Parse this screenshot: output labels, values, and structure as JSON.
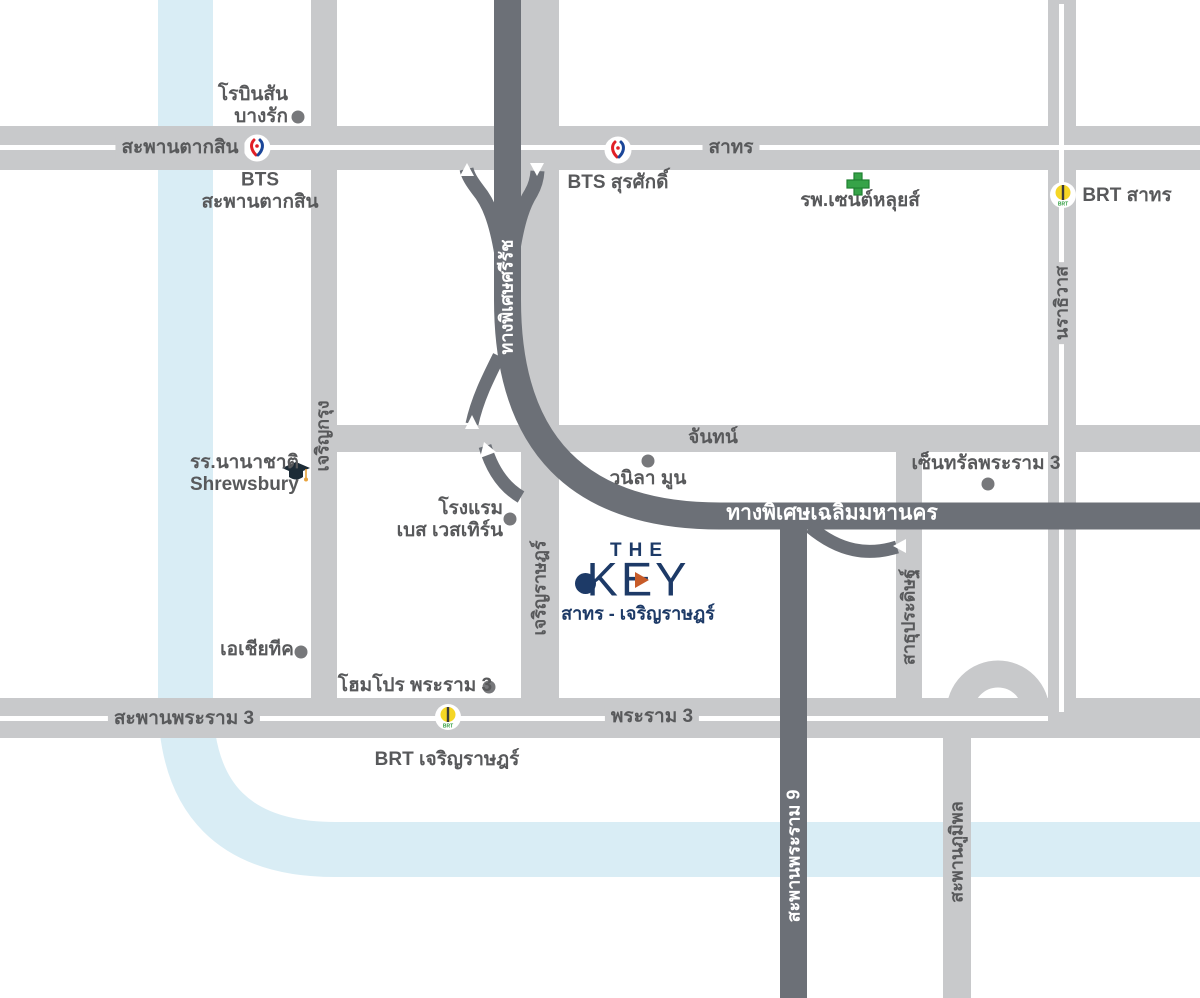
{
  "colors": {
    "road": "#c8c9cb",
    "expressway": "#6c7077",
    "river": "#d9edf5",
    "label_text": "#58595b",
    "brand_navy": "#1d3a67",
    "brand_orange": "#c75b28",
    "hospital_green": "#36a348",
    "brt_yellow": "#f5d625",
    "bts_red": "#e11f26",
    "bts_blue": "#1b4699"
  },
  "logo": {
    "line1": "THE",
    "line2": "KEY",
    "subtitle": "สาทร - เจริญราษฎร์"
  },
  "roads": {
    "saphan_taksin": "สะพานตากสิน",
    "sathorn": "สาทร",
    "chan": "จันทน์",
    "charoen_krung": "เจริญกรุง",
    "charoen_rat": "เจริญราษฎร์",
    "narathiwat": "นราธิวาส",
    "sathu_pradit": "สาธุประดิษฐ์",
    "rama_3": "พระราม 3",
    "saphan_rama_3": "สะพานพระราม 3",
    "saphan_rama_9": "สะพานพระราม 9",
    "saphan_bhumibol": "สะพานภูมิพล",
    "expressway_si_rat": "ทางพิเศษศรีรัช",
    "expressway_chalerm_mahanakhon": "ทางพิเศษเฉลิมมหานคร"
  },
  "transit": {
    "bts_saphan_taksin_line1": "BTS",
    "bts_saphan_taksin_line2": "สะพานตากสิน",
    "bts_surasak": "BTS สุรศักดิ์",
    "brt_sathorn": "BRT สาทร",
    "brt_charoen_rat": "BRT เจริญราษฎร์",
    "brt_icon_text": "BRT"
  },
  "places": {
    "robinson_line1": "โรบินสัน",
    "robinson_line2": "บางรัก",
    "st_louis_hospital": "รพ.เซนต์หลุยส์",
    "shrewsbury_line1": "รร.นานาชาติ",
    "shrewsbury_line2": "Shrewsbury",
    "central_rama_3": "เซ็นทรัลพระราม 3",
    "vanilla_moon": "วนิลา มูน",
    "best_western_line1": "โรงแรม",
    "best_western_line2": "เบส เวสเทิร์น",
    "asiatique": "เอเชียทีค",
    "homepro_rama_3": "โฮมโปร พระราม 3"
  }
}
